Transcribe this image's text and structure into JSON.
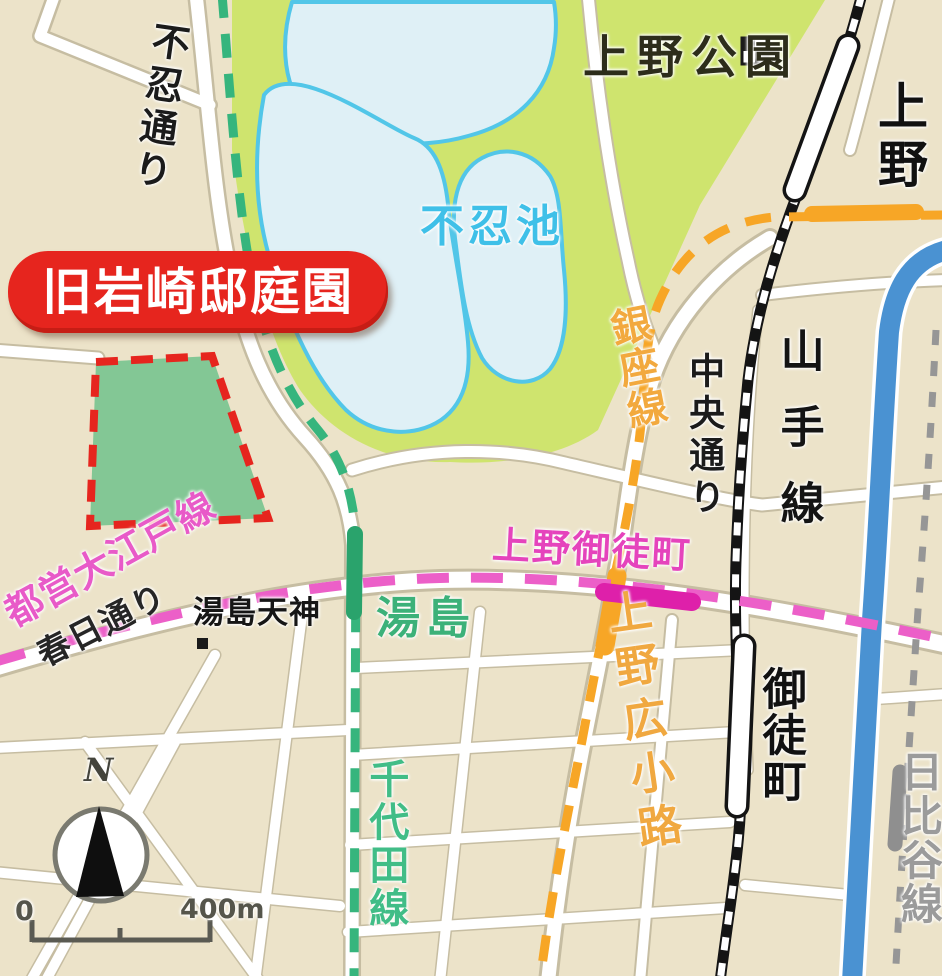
{
  "banner": {
    "label": "旧岩崎邸庭園"
  },
  "park": {
    "label": "上野公園"
  },
  "pond": {
    "label": "不忍池"
  },
  "roads": {
    "shinobazu_dori": {
      "label": "不忍通り"
    },
    "chuo_dori": {
      "label": "中央通り"
    },
    "kasuga_dori": {
      "label": "春日通り"
    }
  },
  "lines": {
    "chiyoda": {
      "label": "千代田線",
      "color": "#36b57d"
    },
    "ginza": {
      "label": "銀座線",
      "color": "#f7a626"
    },
    "oedo": {
      "label": "都営大江戸線",
      "color": "#ec5fc8"
    },
    "yamanote": {
      "label": "山手線",
      "color": "#151515"
    },
    "hibiya": {
      "label": "日比谷線",
      "color": "#969696"
    }
  },
  "stations": {
    "ueno": {
      "label": "上野"
    },
    "okachimachi": {
      "label": "御徒町"
    },
    "yushima": {
      "label": "湯島"
    },
    "ueno_okachimachi": {
      "label": "上野御徒町"
    },
    "ueno_hirokoji": {
      "label": "上野広小路"
    }
  },
  "poi": {
    "yushima_tenjin": {
      "label": "湯島天神"
    }
  },
  "compass": {
    "north": "N"
  },
  "scale_bar": {
    "zero": "0",
    "distance": "400m"
  },
  "icons": {
    "compass_rose": "compass-rose-icon",
    "park_landmark": "checker-landmark-icon",
    "shrine_marker": "square-marker-icon"
  },
  "colors": {
    "background": "#ece3c9",
    "park_green": "#cfe46e",
    "pond_fill": "#dff0f6",
    "pond_outline": "#52c6e8",
    "garden_fill": "#83c795",
    "garden_border": "#e6251e",
    "banner_red": "#e6251e",
    "road_white": "#ffffff",
    "showa_dori_blue": "#4a92d2",
    "oedo_station_magenta": "#de20aa",
    "jr_railway_black": "#141414"
  }
}
